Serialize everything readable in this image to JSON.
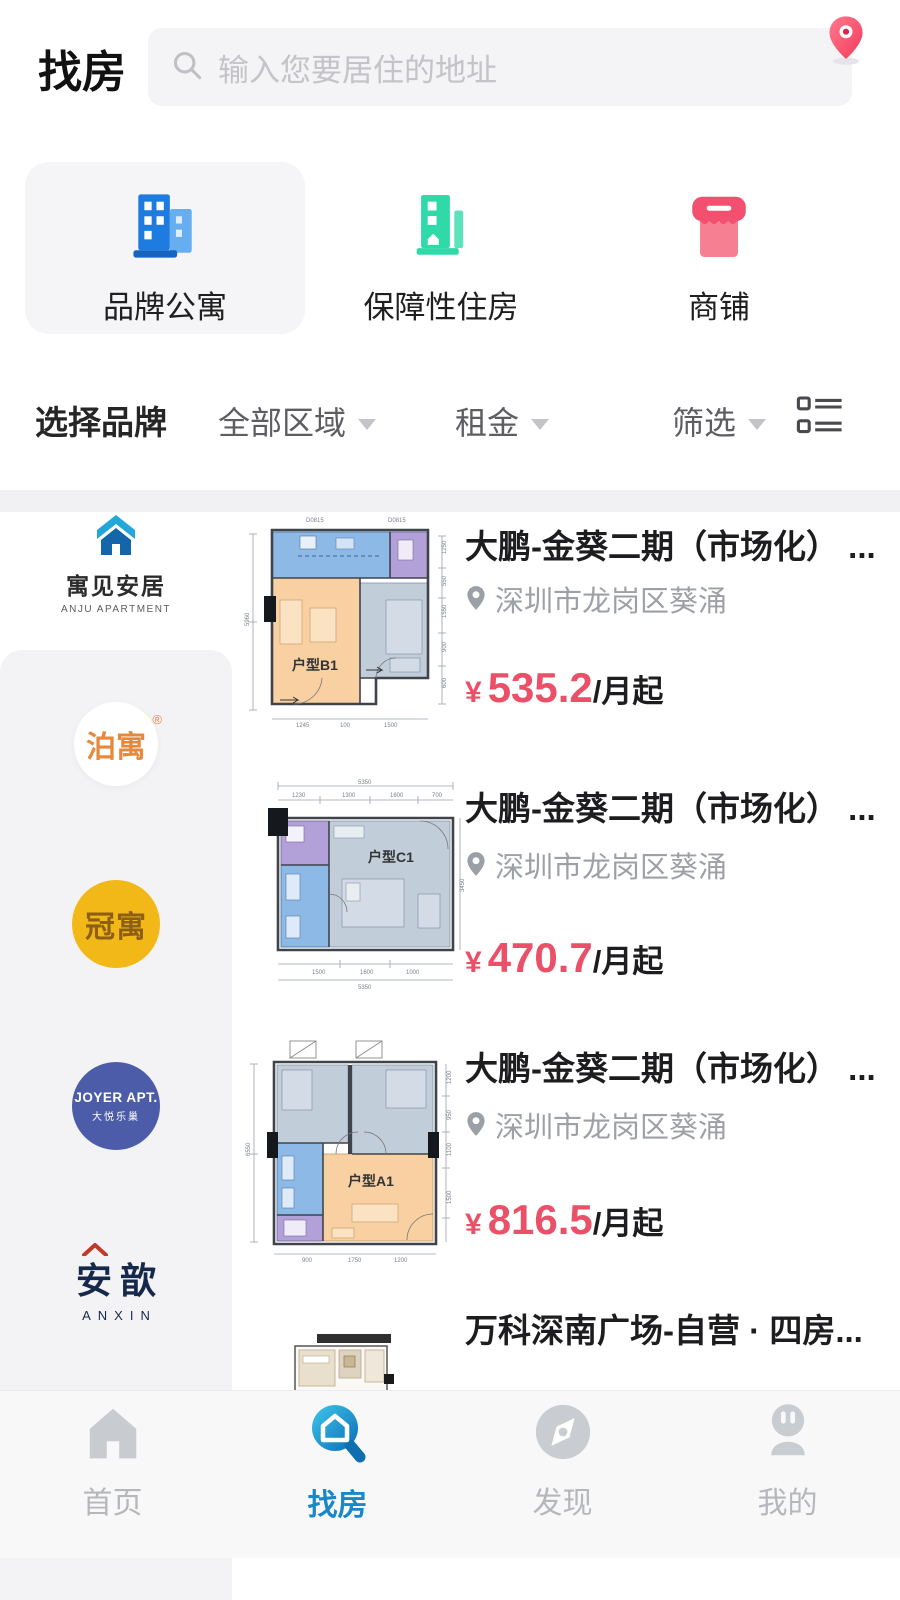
{
  "header": {
    "title": "找房",
    "search_placeholder": "输入您要居住的地址"
  },
  "categories": [
    {
      "label": "品牌公寓",
      "selected": true
    },
    {
      "label": "保障性住房",
      "selected": false
    },
    {
      "label": "商铺",
      "selected": false
    }
  ],
  "filter_bar": {
    "brand": "选择品牌",
    "region": "全部区域",
    "rent": "租金",
    "filter": "筛选"
  },
  "sidebar": {
    "brands": [
      {
        "name": "寓见安居",
        "sub": "ANJU APARTMENT",
        "selected": true
      },
      {
        "name": "泊寓",
        "reg": "®"
      },
      {
        "name": "冠寓"
      },
      {
        "name": "JOYER APT.",
        "sub": "大悦乐巢"
      },
      {
        "name": "安歆",
        "sub": "ANXIN"
      }
    ]
  },
  "listings": [
    {
      "title": "大鹏-金葵二期（市场化） ...",
      "location": "深圳市龙岗区葵涌",
      "currency": "¥",
      "price": "535.2",
      "unit": "/月起",
      "plan": {
        "label": "户型B1",
        "dim_left": "5960",
        "dims_top": [
          "D0815",
          "D0815"
        ],
        "dims_right": [
          "1250",
          "550",
          "1550",
          "900",
          "600"
        ],
        "dims_bottom": [
          "1245",
          "100",
          "1500"
        ]
      }
    },
    {
      "title": "大鹏-金葵二期（市场化） ...",
      "location": "深圳市龙岗区葵涌",
      "currency": "¥",
      "price": "470.7",
      "unit": "/月起",
      "plan": {
        "label": "户型C1",
        "dim_total_top": "5350",
        "dims_top": [
          "1230",
          "1300",
          "1600",
          "700"
        ],
        "dims_bottom": [
          "1500",
          "1600",
          "1000"
        ],
        "dim_total_bottom": "5350",
        "dim_right": "3450"
      }
    },
    {
      "title": "大鹏-金葵二期（市场化） ...",
      "location": "深圳市龙岗区葵涌",
      "currency": "¥",
      "price": "816.5",
      "unit": "/月起",
      "plan": {
        "label": "户型A1",
        "dim_left": "6550",
        "dims_right": [
          "1200",
          "950",
          "1100",
          "1500"
        ],
        "dims_bottom": [
          "900",
          "1750",
          "1200"
        ]
      }
    },
    {
      "title": "万科深南广场-自营 · 四房..."
    }
  ],
  "tabbar": [
    {
      "label": "首页",
      "active": false
    },
    {
      "label": "找房",
      "active": true
    },
    {
      "label": "发现",
      "active": false
    },
    {
      "label": "我的",
      "active": false
    }
  ],
  "colors": {
    "price_red": "#ea5168",
    "pin_red": "#f23a5c",
    "category_blue": "#1e7ce0",
    "category_teal": "#2fd9a8",
    "category_pink": "#f2506e",
    "tab_active_blue": "#1a87c6",
    "brand_gold": "#f2b818",
    "brand_navy": "#4d5ca9"
  }
}
